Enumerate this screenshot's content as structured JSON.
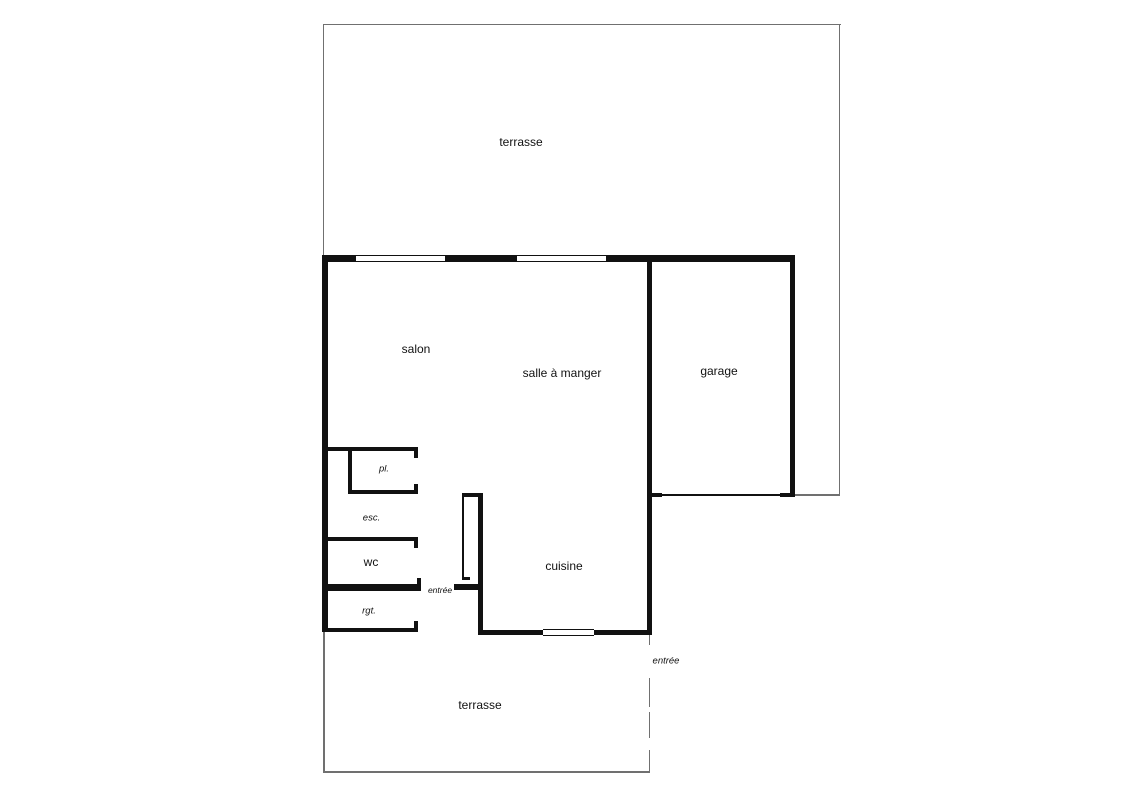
{
  "colors": {
    "wall": "#111111",
    "outline": "#707070",
    "text": "#111111",
    "bg": "#ffffff"
  },
  "rooms": {
    "terrace_top": "terrasse",
    "salon": "salon",
    "dining_room": "salle à manger",
    "garage": "garage",
    "kitchen": "cuisine",
    "wc": "wc",
    "closet": "pl.",
    "stairs": "esc.",
    "storage": "rgt.",
    "entry_inner": "entrée",
    "entry_outer": "entrée",
    "terrace_bottom": "terrasse"
  }
}
